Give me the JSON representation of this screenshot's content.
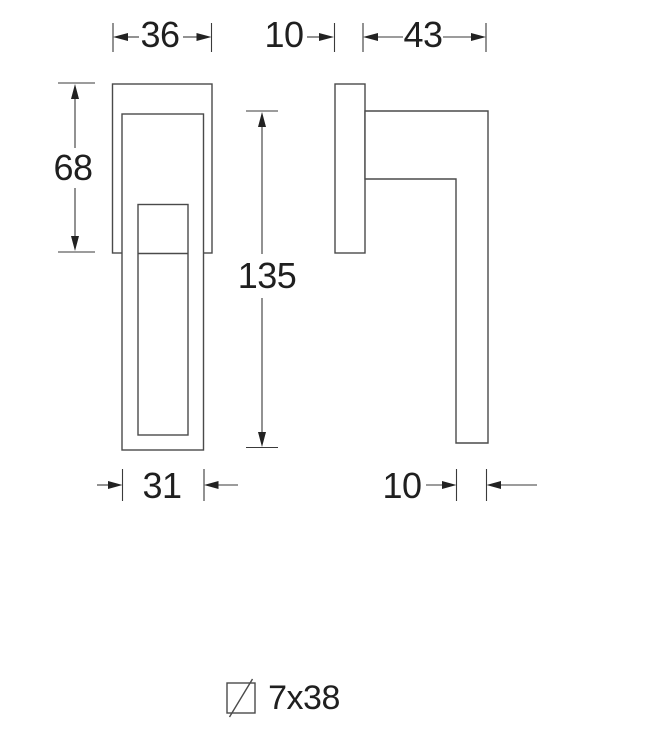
{
  "drawing": {
    "type": "technical-dimension-drawing",
    "subject": "window/door handle, front view and side view",
    "colors": {
      "background": "#ffffff",
      "outline": "#4a4a4a",
      "dimension_line": "#3a3a3a",
      "text": "#1f1f1f"
    },
    "views": [
      {
        "id": "front-view",
        "description": "front elevation of handle on rectangular rose plate"
      },
      {
        "id": "side-view",
        "description": "side profile of rose plate with L-shaped lever"
      }
    ],
    "dims": {
      "rose_width": "36",
      "rose_thickness": "10",
      "projection": "43",
      "rose_height": "68",
      "handle_length": "135",
      "handle_width": "31",
      "lever_thickness": "10"
    },
    "legend": {
      "spindle_icon": "square-with-diagonal-slash",
      "spindle_label": "7x38"
    }
  }
}
